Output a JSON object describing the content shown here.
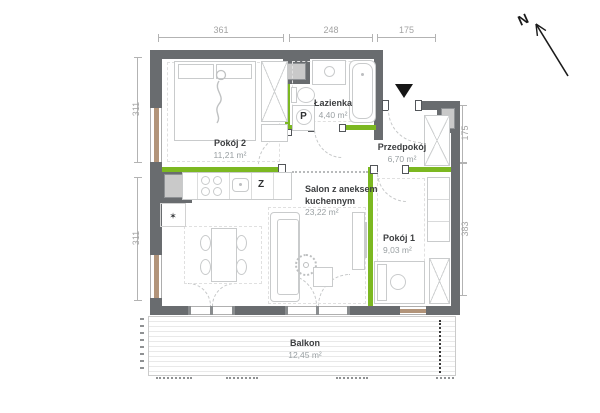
{
  "plan_type": "apartment-floor-plan",
  "rooms": {
    "pokoj2": {
      "name": "Pokój 2",
      "area": "11,21 m²"
    },
    "lazienka": {
      "name": "Łazienka",
      "area": "4,40 m²"
    },
    "przedpokoj": {
      "name": "Przedpokój",
      "area": "6,70 m²"
    },
    "salon": {
      "name": "Salon z aneksem kuchennym",
      "area": "23,22 m²"
    },
    "pokoj1": {
      "name": "Pokój 1",
      "area": "9,03 m²"
    },
    "balkon": {
      "name": "Balkon",
      "area": "12,45 m²"
    }
  },
  "dimensions_cm": {
    "top": [
      "361",
      "248",
      "175"
    ],
    "left": [
      "311",
      "311"
    ],
    "right": [
      "175",
      "383"
    ],
    "bottom": [
      "606",
      "236"
    ]
  },
  "labels": {
    "washing_machine": "P",
    "dishwasher": "Z",
    "star": "✶",
    "north": "N"
  },
  "colors": {
    "structural_wall": "#696c6f",
    "partition_wall_green": "#7cb821",
    "window_sill_brown": "#b2947a",
    "shaft_fill": "#c9c9c9"
  }
}
